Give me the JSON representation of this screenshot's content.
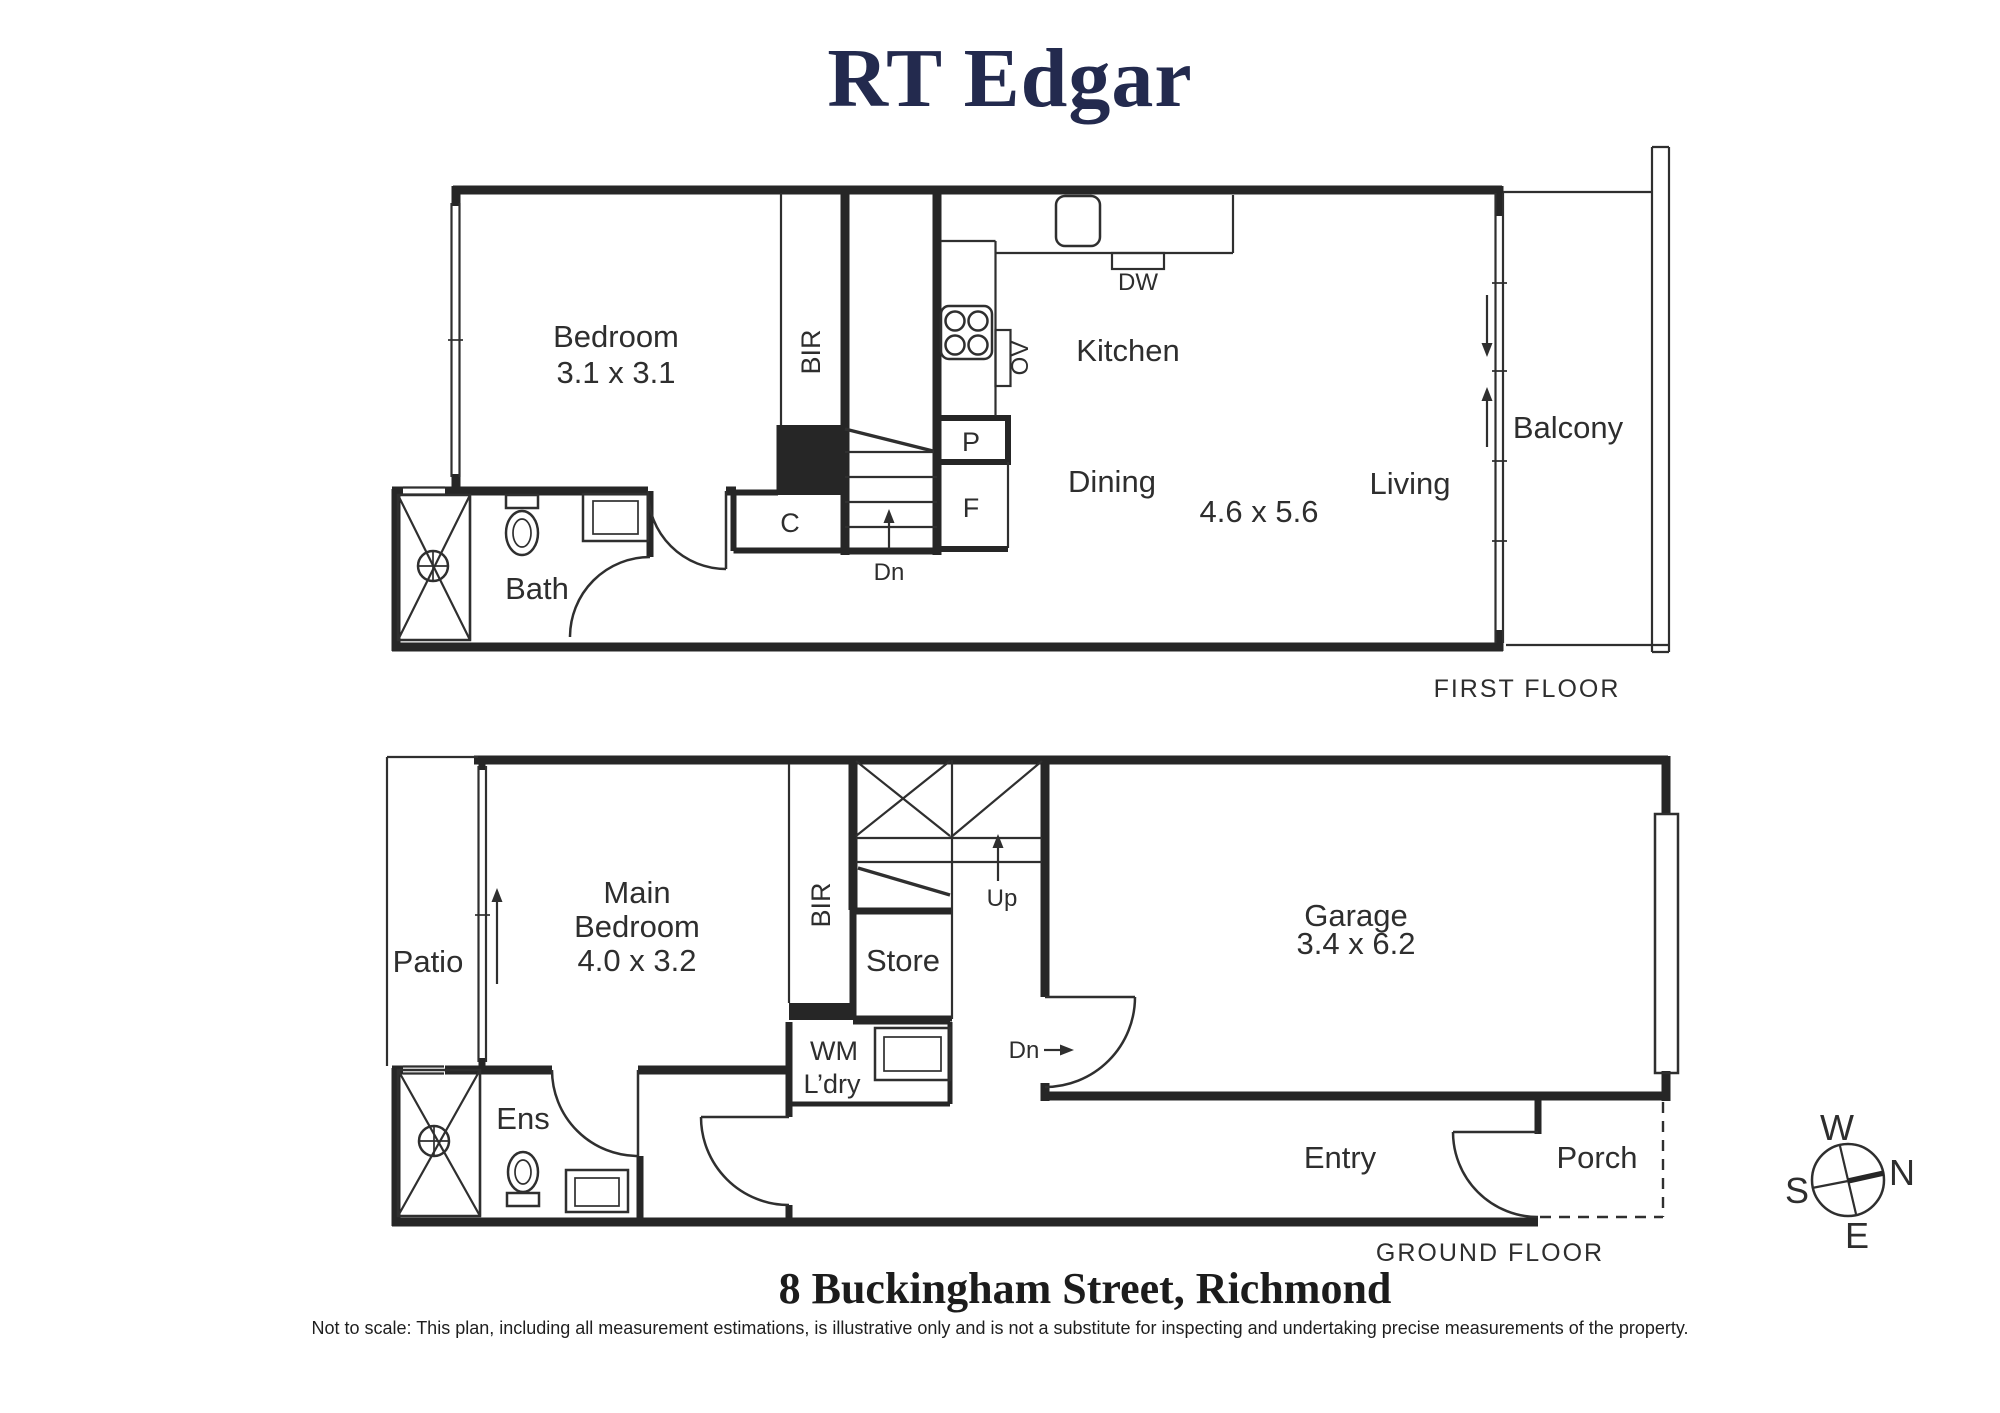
{
  "title": "RT Edgar",
  "first_floor": {
    "caption": "FIRST FLOOR",
    "labels": {
      "bedroom": "Bedroom",
      "bedroom_dims": "3.1 x 3.1",
      "bir": "BIR",
      "kitchen": "Kitchen",
      "dining": "Dining",
      "living_dims": "4.6 x 5.6",
      "living": "Living",
      "balcony": "Balcony",
      "bath": "Bath",
      "cupboard": "C",
      "pantry": "P",
      "fridge": "F",
      "dishwasher": "DW",
      "oven": "OV",
      "down": "Dn"
    }
  },
  "ground_floor": {
    "caption": "GROUND FLOOR",
    "labels": {
      "patio": "Patio",
      "main_bedroom_line1": "Main",
      "main_bedroom_line2": "Bedroom",
      "main_bedroom_dims": "4.0 x 3.2",
      "bir": "BIR",
      "store": "Store",
      "up": "Up",
      "wm": "WM",
      "laundry": "L’dry",
      "ensuite": "Ens",
      "down": "Dn",
      "garage": "Garage",
      "garage_dims": "3.4 x 6.2",
      "entry": "Entry",
      "porch": "Porch"
    }
  },
  "compass": {
    "west": "W",
    "north": "N",
    "south": "S",
    "east": "E"
  },
  "footer": {
    "address": "8 Buckingham Street, Richmond",
    "disclaimer": "Not to scale: This plan, including all measurement estimations, is illustrative only and is not a substitute for inspecting and undertaking precise measurements of the property."
  },
  "colors": {
    "wall": "#262626",
    "brand_navy": "#232a4e",
    "text": "#2e2e2e"
  }
}
